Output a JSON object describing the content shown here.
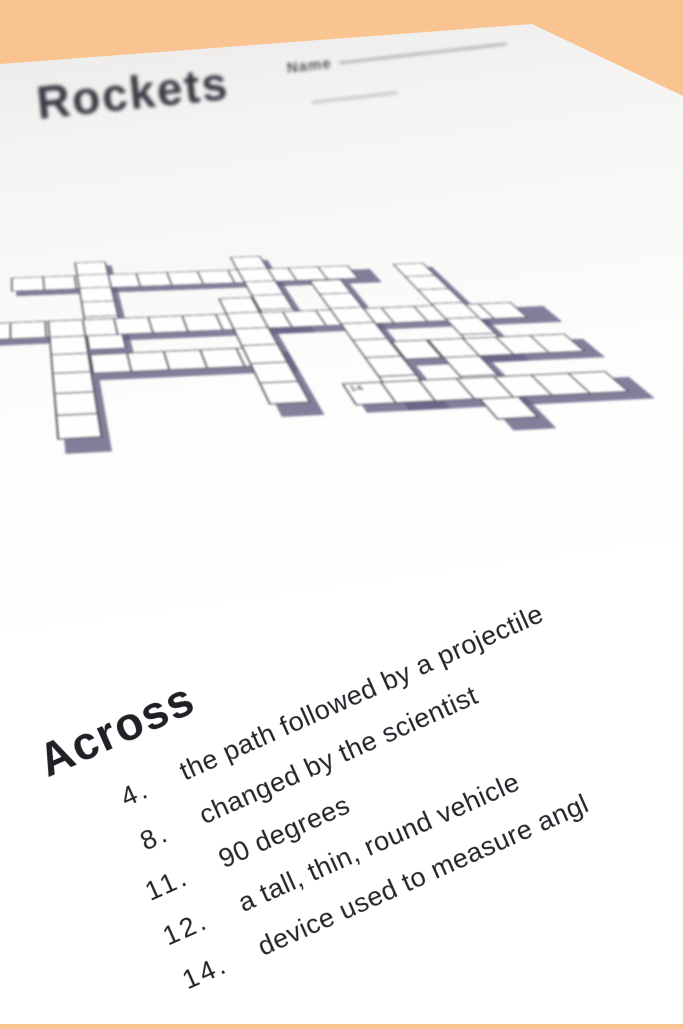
{
  "colors": {
    "background": "#F9C491",
    "paper": "#FFFFFF",
    "paper_far_edge": "#E9E8E6",
    "grid_line": "#54545F",
    "grid_shadow": "#676385",
    "title_text": "#3A3A44",
    "clue_text": "#24242B"
  },
  "worksheet": {
    "title": "Rockets",
    "name_label": "Name",
    "grid": {
      "cell_size": 46,
      "cols": 16,
      "rows": 11,
      "visible_numbers": [
        "14"
      ],
      "shadow_offset": {
        "x": 7,
        "y": 15
      },
      "words": [
        {
          "dir": "h",
          "row": 1,
          "col": 1,
          "len": 11
        },
        {
          "dir": "v",
          "row": 0,
          "col": 3,
          "len": 6
        },
        {
          "dir": "v",
          "row": 0,
          "col": 8,
          "len": 5
        },
        {
          "dir": "h",
          "row": 4,
          "col": 0,
          "len": 16
        },
        {
          "dir": "v",
          "row": 4,
          "col": 2,
          "len": 6
        },
        {
          "dir": "h",
          "row": 6,
          "col": 3,
          "len": 5
        },
        {
          "dir": "v",
          "row": 3,
          "col": 7,
          "len": 6
        },
        {
          "dir": "v",
          "row": 2,
          "col": 10,
          "len": 7
        },
        {
          "dir": "v",
          "row": 1,
          "col": 13,
          "len": 6
        },
        {
          "dir": "h",
          "row": 6,
          "col": 11,
          "len": 5
        },
        {
          "dir": "v",
          "row": 6,
          "col": 12,
          "len": 4
        },
        {
          "dir": "h",
          "row": 8,
          "col": 9,
          "len": 7,
          "number": "14"
        }
      ]
    },
    "across": {
      "heading": "Across",
      "clues": [
        {
          "number": "4.",
          "text": "the path followed by a projectile"
        },
        {
          "number": "8.",
          "text": "changed by the scientist"
        },
        {
          "number": "11.",
          "text": "90 degrees"
        },
        {
          "number": "12.",
          "text": "a tall, thin, round vehicle"
        },
        {
          "number": "14.",
          "text": "device used to measure angl"
        }
      ]
    }
  }
}
